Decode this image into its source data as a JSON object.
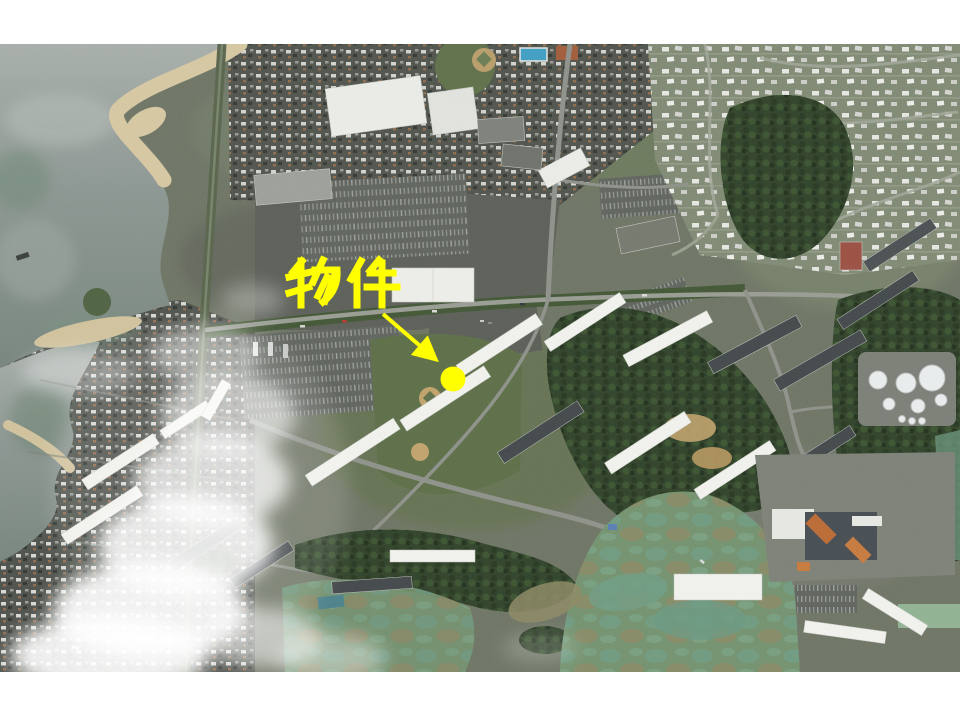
{
  "slide": {
    "background_color": "#ffffff",
    "photo_area": {
      "x": 0,
      "y": 44,
      "width": 960,
      "height": 628
    }
  },
  "annotation": {
    "label": "物件",
    "color": "#ffff00",
    "label_box": {
      "x": 285,
      "y": 255,
      "width": 110,
      "height": 52
    },
    "arrow": {
      "from_x": 383,
      "from_y": 314,
      "to_x": 433,
      "to_y": 357
    },
    "marker": {
      "x": 453,
      "y": 379,
      "radius": 12.5
    }
  },
  "map": {
    "type": "satellite-aerial-photo",
    "palette": {
      "annotation_yellow": "#ffff00",
      "land_base": "#6e7565",
      "water": "#8d9793",
      "sand": "#d9c9a4",
      "forest": "#2f4129",
      "dense_city": "#4d514b",
      "suburb": "#808a74",
      "grass": "#5e7049",
      "marsh_teal": "#6f9e85",
      "road": "#8e928b",
      "building_white": "#f4f4f0",
      "building_dark": "#42474a",
      "cloud": "#ffffff",
      "pool_blue": "#3f9fc6",
      "diamond_tan": "#bb9e6b",
      "hospital_orange": "#bd6a33"
    }
  }
}
